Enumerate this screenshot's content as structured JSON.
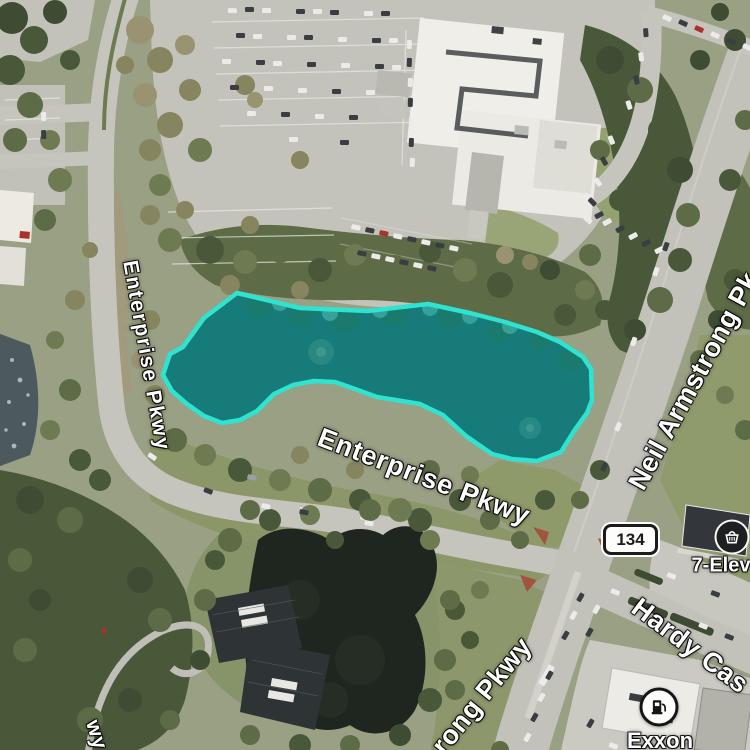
{
  "map": {
    "road_labels": [
      {
        "id": "enterprise-pkwy-west",
        "text": "Enterprise Pkwy"
      },
      {
        "id": "enterprise-pkwy-center",
        "text": "Enterprise Pkwy"
      },
      {
        "id": "neil-armstrong-pkwy",
        "text": "Neil Armstrong Pk"
      },
      {
        "id": "armstrong-pkwy-south",
        "text": "rong Pkwy"
      },
      {
        "id": "hardy-cast",
        "text": "Hardy Cas"
      },
      {
        "id": "pkwy-partial-bottom-left",
        "text": "wy"
      }
    ],
    "route_shield": {
      "text": "134"
    },
    "pois": [
      {
        "label": "7-Elev",
        "icon": "convenience-store-icon"
      },
      {
        "label": "Exxon",
        "icon": "gas-station-icon"
      }
    ],
    "selection": {
      "points": "237,293 300,308 368,311 428,304 470,313 505,322 537,332 560,342 583,357 591,369 592,400 587,413 574,431 561,452 537,461 512,459 492,454 466,436 443,415 420,404 402,401 377,397 355,389 335,382 314,381 293,385 274,394 257,411 240,420 222,423 204,416 187,404 172,391 163,375 170,354 183,347 204,318",
      "stroke_color": "#2fe3d1",
      "fill_color": "rgba(47,227,209,0.30)"
    },
    "colors": {
      "road": "#c6c5bd",
      "forest_dark": "#4a583a",
      "forest": "#5d6b46",
      "grass": "#8b9768",
      "water_dark": "#1f261f",
      "selected_water": "#0d4e53",
      "selection_stroke": "#2fe3d1"
    }
  }
}
